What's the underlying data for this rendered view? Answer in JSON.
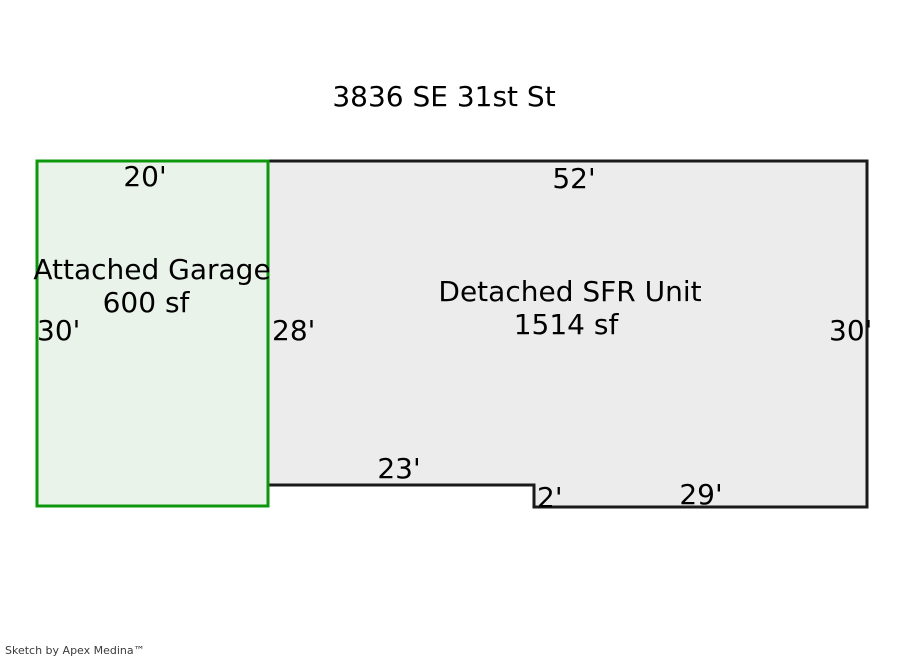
{
  "title": "3836 SE 31st St",
  "footer": "Sketch by Apex Medina™",
  "colors": {
    "garage_fill": "#eaf3ea",
    "garage_stroke": "#0c970c",
    "sfr_fill": "#ececec",
    "sfr_stroke": "#1a1a1a",
    "text": "#000000",
    "footer_text": "#3b3b3b"
  },
  "garage": {
    "name": "Attached Garage",
    "area": "600 sf",
    "dim_top": "20'",
    "dim_left": "30'",
    "dim_right": "28'"
  },
  "sfr": {
    "name": "Detached SFR Unit",
    "area": "1514 sf",
    "dim_top": "52'",
    "dim_right": "30'",
    "dim_bottom_left": "23'",
    "dim_step": "2'",
    "dim_bottom_right": "29'"
  }
}
